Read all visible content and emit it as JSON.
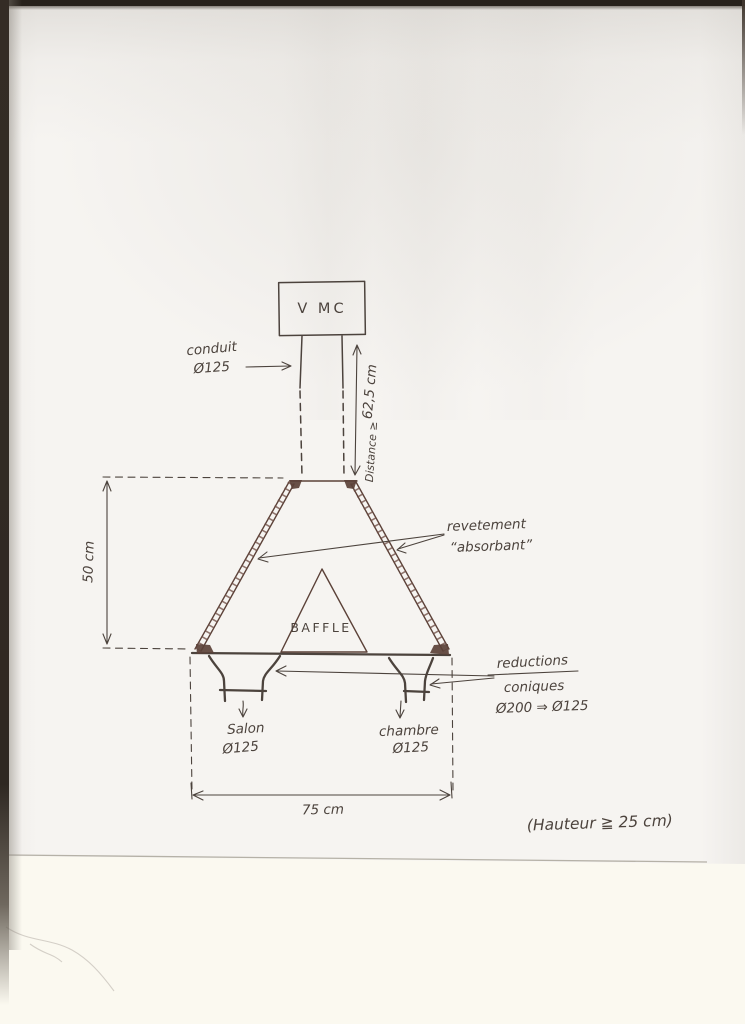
{
  "colors": {
    "ink": "#4c433d",
    "funnel_ink": "#5b4138",
    "hatch_ink": "#6e4c43",
    "paper": "#f6f4f1",
    "below_sheet": "#fbf9f0",
    "scan_border": "#27211b"
  },
  "labels": {
    "vmc": "V MC",
    "conduit_line1": "conduit",
    "conduit_line2": "Ø125",
    "distance_value": "62,5 cm",
    "distance_word": "Distance ≥",
    "dim_height": "50 cm",
    "baffle": "BAFFLE",
    "coating_line1": "revetement",
    "coating_line2": "“absorbant”",
    "reduction_line1": "reductions",
    "reduction_line2": "coniques",
    "reduction_line3": "Ø200 ⇒ Ø125",
    "outlet_left_name": "Salon",
    "outlet_left_dia": "Ø125",
    "outlet_right_name": "chambre",
    "outlet_right_dia": "Ø125",
    "dim_width": "75 cm",
    "height_note": "(Hauteur ≧ 25 cm)"
  }
}
